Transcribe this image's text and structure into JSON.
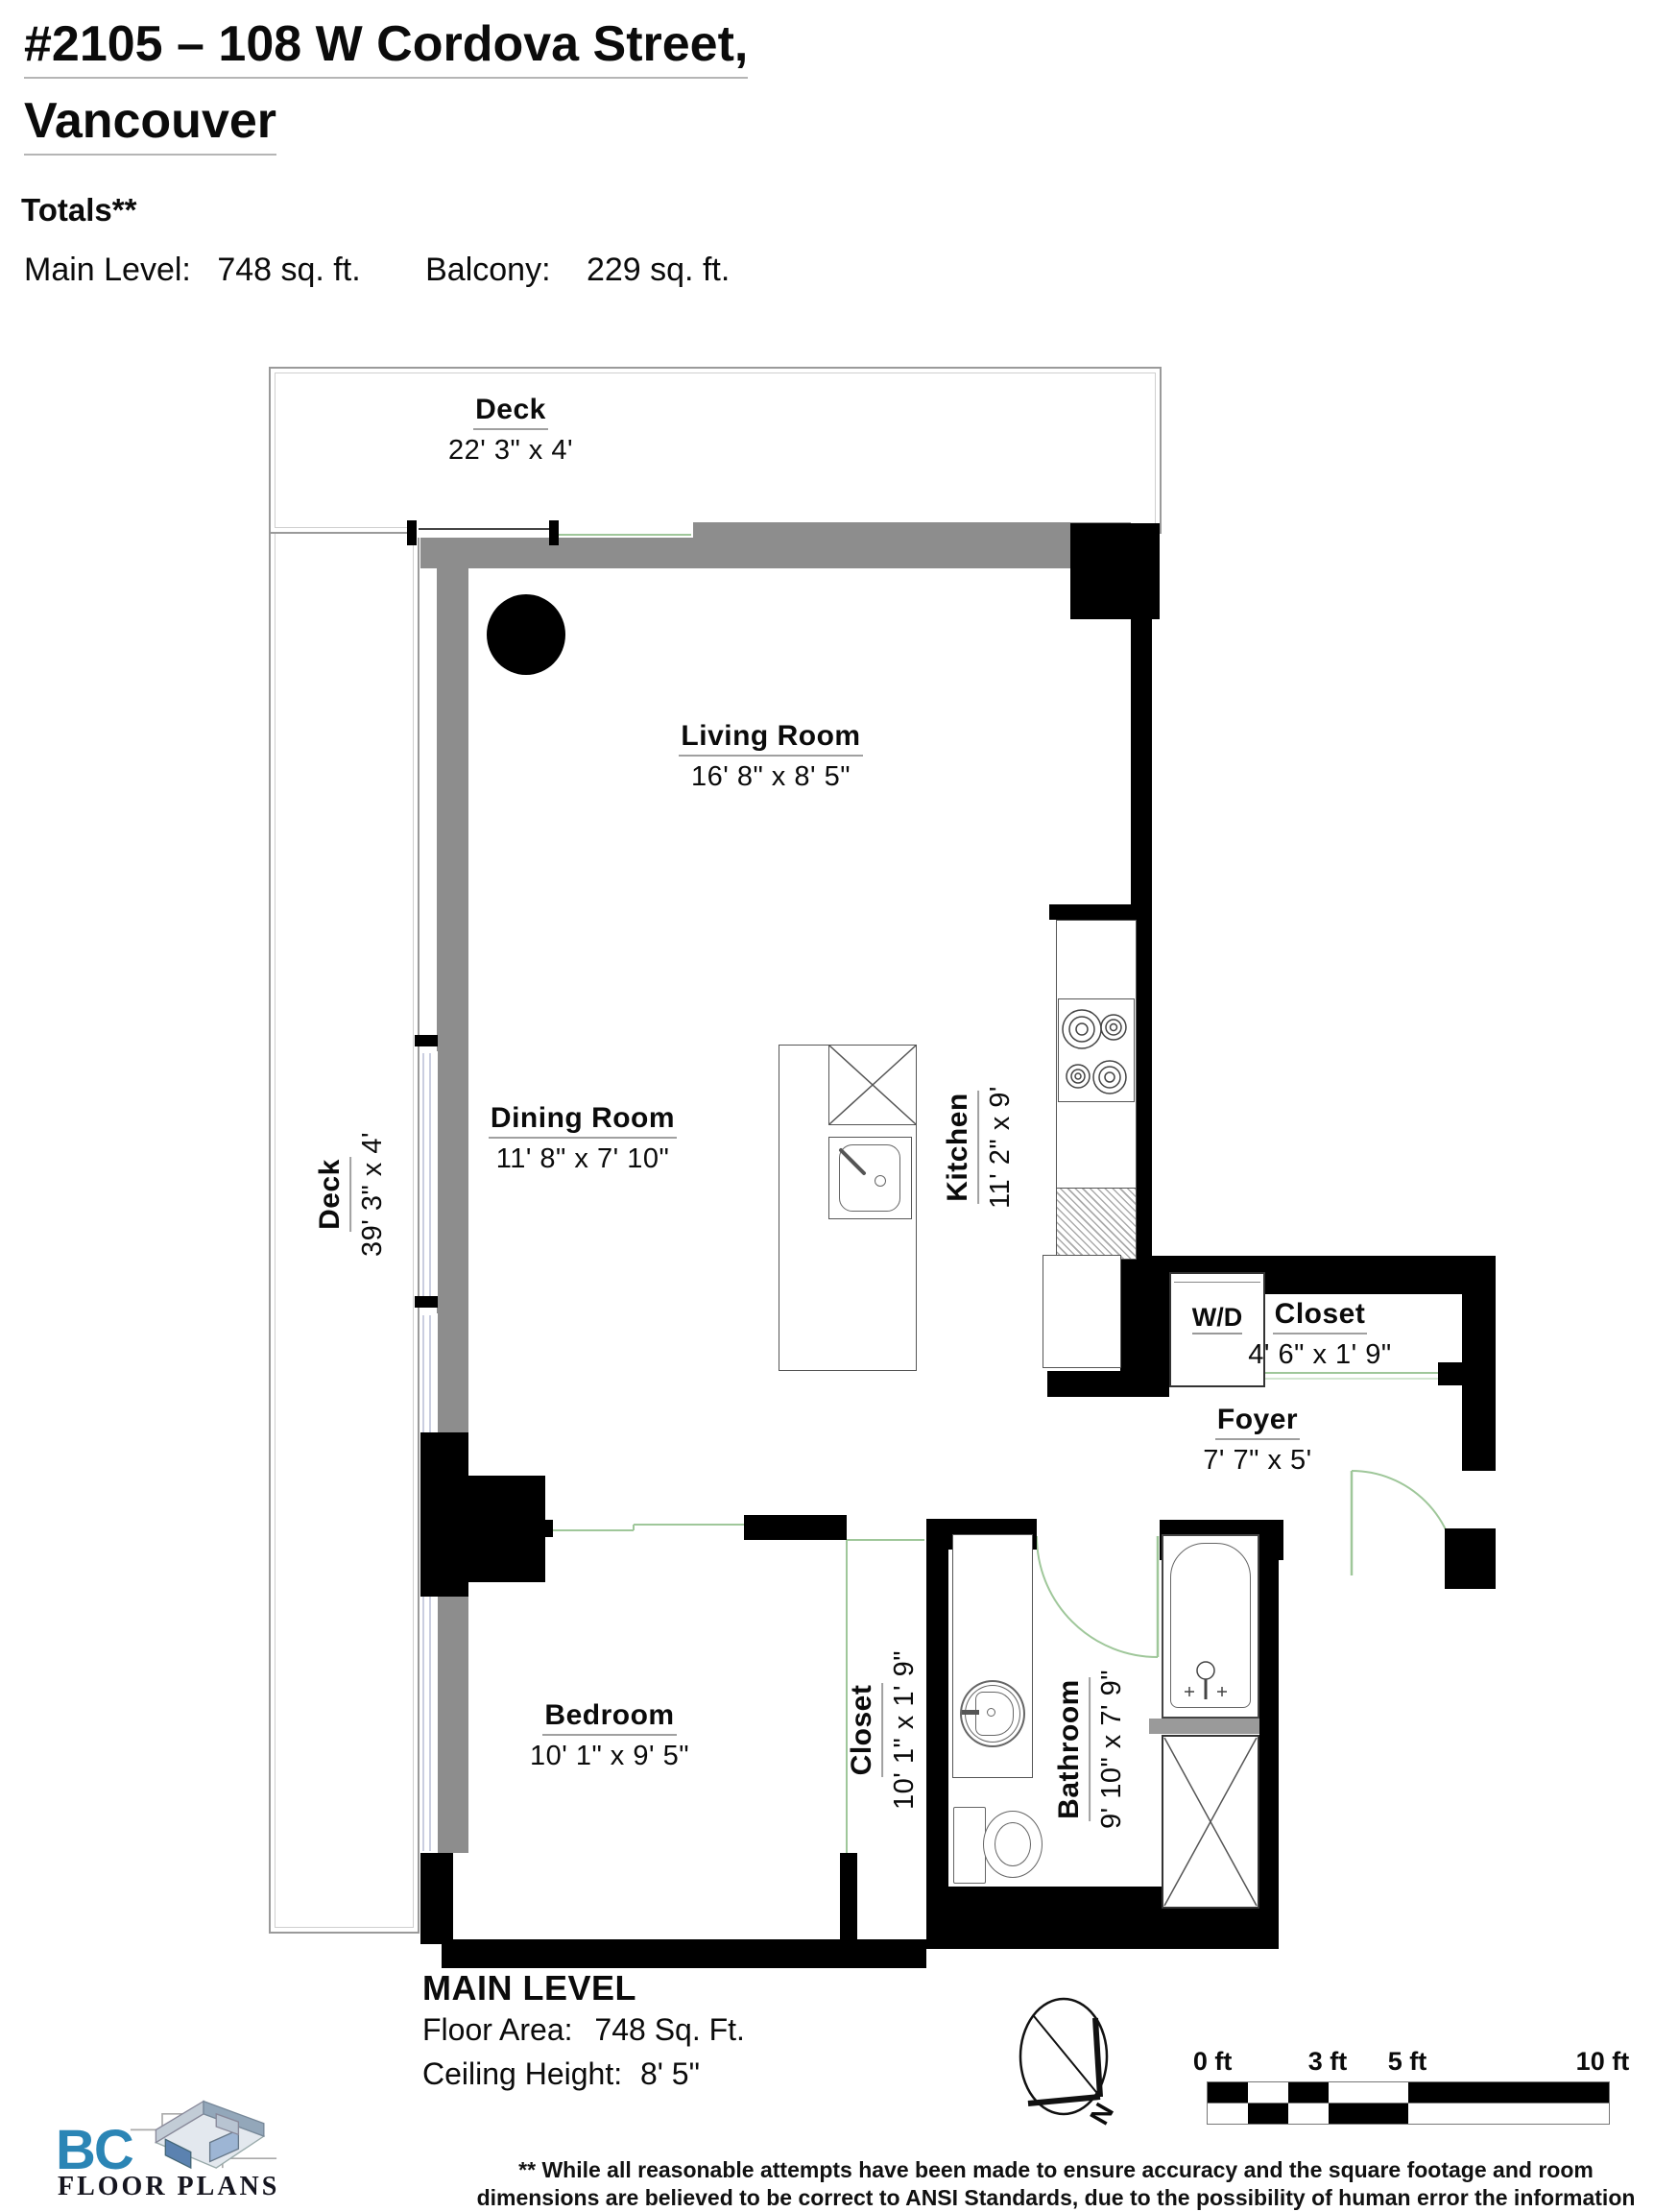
{
  "header": {
    "title_line1": "#2105 – 108 W Cordova Street,",
    "title_line2": "Vancouver",
    "totals_label": "Totals**",
    "main_level_label": "Main Level:",
    "main_level_value": "748 sq. ft.",
    "balcony_label": "Balcony:",
    "balcony_value": "229 sq. ft."
  },
  "rooms": {
    "deck_top": {
      "name": "Deck",
      "dims": "22' 3\" x 4'"
    },
    "deck_left": {
      "name": "Deck",
      "dims": "39' 3\" x 4'"
    },
    "living_room": {
      "name": "Living Room",
      "dims": "16' 8\" x 8' 5\""
    },
    "dining_room": {
      "name": "Dining Room",
      "dims": "11' 8\" x 7' 10\""
    },
    "kitchen": {
      "name": "Kitchen",
      "dims": "11' 2\" x 9'"
    },
    "washer_dryer": {
      "name": "W/D"
    },
    "entry_closet": {
      "name": "Closet",
      "dims": "4' 6\" x 1' 9\""
    },
    "foyer": {
      "name": "Foyer",
      "dims": "7' 7\" x 5'"
    },
    "bedroom": {
      "name": "Bedroom",
      "dims": "10' 1\" x 9' 5\""
    },
    "bedroom_closet": {
      "name": "Closet",
      "dims": "10' 1\" x 1' 9\""
    },
    "bathroom": {
      "name": "Bathroom",
      "dims": "9' 10\" x 7' 9\""
    }
  },
  "footer": {
    "level_title": "MAIN LEVEL",
    "floor_area_label": "Floor Area:",
    "floor_area_value": "748 Sq. Ft.",
    "ceiling_label": "Ceiling Height:",
    "ceiling_value": "8' 5\"",
    "compass_label": "N"
  },
  "scale_bar": {
    "labels": [
      "0 ft",
      "3 ft",
      "5 ft",
      "10 ft"
    ]
  },
  "disclaimer": "** While all reasonable attempts have been made to ensure accuracy and the square footage and room dimensions are believed to be correct to ANSI Standards, due to the possibility of human error the information cannot be guaranteed. E&O Insured for $1,000,000",
  "logo": {
    "bc": "BC",
    "floor_plans": "FLOOR PLANS"
  },
  "colors": {
    "wall": "#000000",
    "balcony_wall": "#8d8d8d",
    "door_line": "#9fc79a",
    "logo_blue": "#2b85b5"
  }
}
